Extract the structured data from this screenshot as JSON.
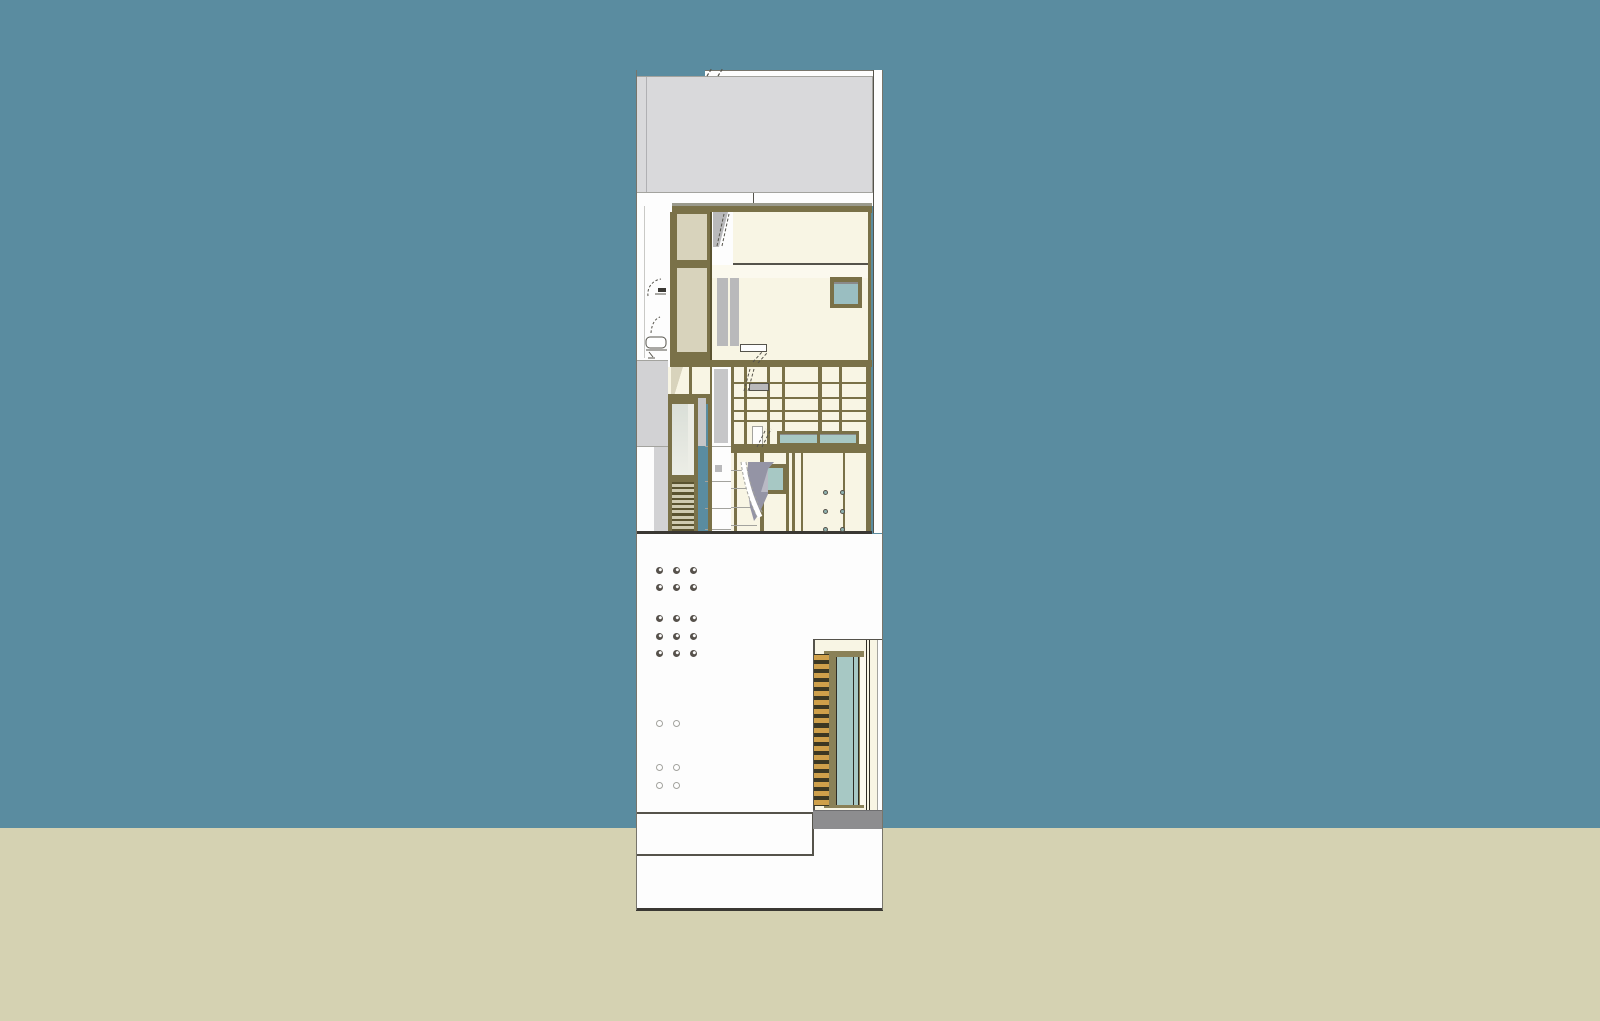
{
  "viewport": {
    "kind": "3d-architectural-model-view",
    "subject": "narrow-townhouse-section-elevation"
  },
  "colors": {
    "sky": "#5a8ca0",
    "ground": "#d5d2b2",
    "parapet": "#d9d9db",
    "parapet_line": "#b0b0b3",
    "white": "#fdfdfd",
    "cream": "#f8f5e4",
    "cream_bright": "#fbf9ee",
    "olive": "#7a7148",
    "olive_deep": "#5a5330",
    "olive_door": "#8a8157",
    "beige": "#d8d3bc",
    "slat_light": "#cfcab0",
    "glass_teal": "#a7c8c4",
    "glass_teal_deep": "#9abec1",
    "glass_pale": "#dadfd8",
    "glass_pale_light": "#ecede6",
    "glass_shadow": "#8a8a8a",
    "wood": "#cfa04a",
    "wood_dark": "#3c3823",
    "gray_light": "#d2d2d4",
    "gray_mid": "#b9b9bb",
    "gray_panel": "#c6c6c8",
    "gray_dark": "#8d8d8f",
    "lavender": "#9494a5",
    "lavender_light": "#b9b9c4",
    "line_dark": "#3a3833",
    "line": "#55534b",
    "line_soft": "#a3a39e",
    "edge": "#77756b",
    "band_shadow": "#9a9a8c",
    "service_line": "#c9c9c6",
    "door_line": "#2e2c24",
    "threshold_edge": "#6e6e70",
    "dot_dark": "#56514b",
    "dot_teal": "#8fb3b0"
  },
  "patterns": {
    "vent_dots_filled": {
      "cols_x": [
        659,
        676,
        693
      ],
      "rows_y": [
        570,
        587,
        618,
        636,
        653
      ],
      "size": 7,
      "style": "dot-filled"
    },
    "vent_dots_open": {
      "cols_x": [
        659,
        676
      ],
      "rows_y": [
        723,
        767,
        785
      ],
      "size": 7,
      "style": "dot-open"
    },
    "stair_dots": {
      "cols_x": [
        825,
        842
      ],
      "rows_y": [
        492,
        511,
        529
      ],
      "size": 5,
      "style": "dot-teal"
    },
    "mid_louver": {
      "slats": 9
    },
    "door_louver": {
      "slats": 17
    }
  }
}
